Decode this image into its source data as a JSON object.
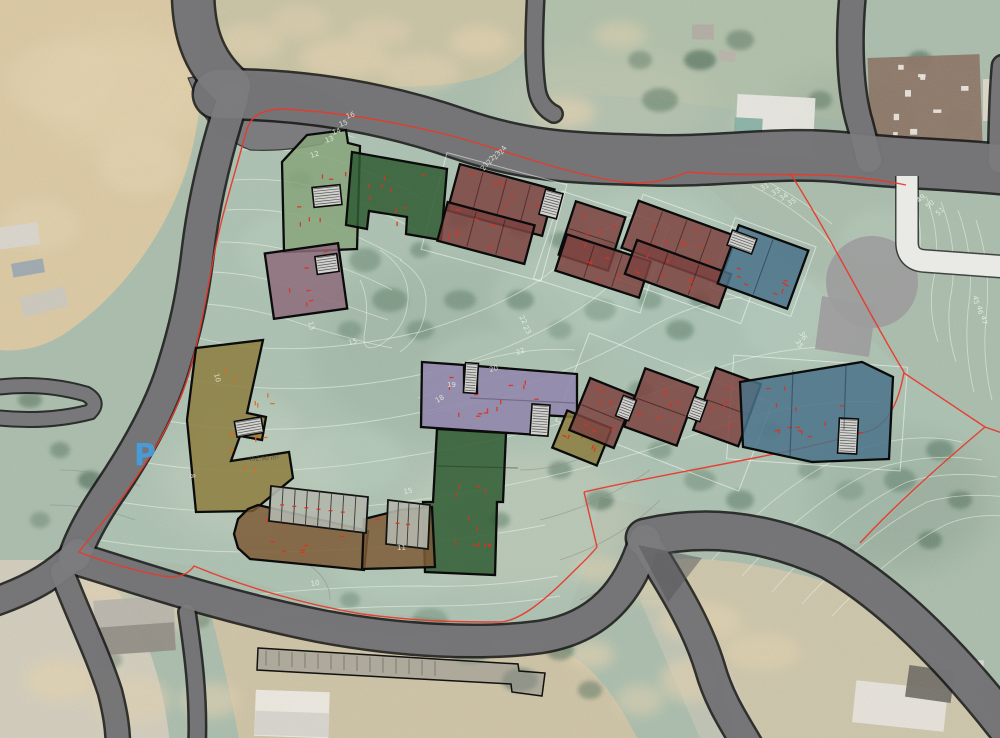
{
  "scene": {
    "description": "Architectural masterplan site plan overlaid on an aerial photograph with terraced housing blocks, contour lines and red plot boundary",
    "canvas_width": 1000,
    "canvas_height": 738
  },
  "palette": {
    "base_green": "#a9bcab",
    "road_fill": "#7c7c7e",
    "road_casing": "#151515",
    "white_path": "#e9e9e5",
    "plaza_gray": "#9d9d9d",
    "boundary_red": "#e8392b",
    "contour_light": "#edf4e4",
    "contour_gray": "#8f8c82",
    "stair_fill": "#d2d2cf",
    "tick_red": "#e0301e",
    "tick_orange": "#e8641c",
    "parking_blue": "#3fa2e8",
    "green_light": "#87a47b",
    "green_dark": "#2f5c33",
    "maroon": "#7c4341",
    "blue": "#4a7289",
    "purple": "#8f84ab",
    "mauve": "#8d6b7a",
    "olive": "#8c7d3e",
    "brown": "#7d5a36"
  },
  "labels": {
    "parking": {
      "text": "P",
      "color": "#3fa2e8"
    },
    "area_note": {
      "text": "452.90 m²",
      "x": 248,
      "y": 461,
      "r": -3
    },
    "contour_labels": [
      {
        "t": "16",
        "x": 347,
        "y": 119,
        "r": -20
      },
      {
        "t": "15",
        "x": 340,
        "y": 127,
        "r": -20
      },
      {
        "t": "14",
        "x": 333,
        "y": 135,
        "r": -20
      },
      {
        "t": "13",
        "x": 326,
        "y": 143,
        "r": -20
      },
      {
        "t": "12",
        "x": 311,
        "y": 158,
        "r": -18
      },
      {
        "t": "21",
        "x": 484,
        "y": 171,
        "r": -55
      },
      {
        "t": "22",
        "x": 490,
        "y": 165,
        "r": -55
      },
      {
        "t": "23",
        "x": 496,
        "y": 160,
        "r": -55
      },
      {
        "t": "24",
        "x": 502,
        "y": 155,
        "r": -55
      },
      {
        "t": "31",
        "x": 762,
        "y": 191,
        "r": -30
      },
      {
        "t": "33",
        "x": 773,
        "y": 196,
        "r": -30
      },
      {
        "t": "34",
        "x": 781,
        "y": 201,
        "r": -30
      },
      {
        "t": "35",
        "x": 789,
        "y": 206,
        "r": -30
      },
      {
        "t": "49",
        "x": 919,
        "y": 203,
        "r": -40
      },
      {
        "t": "50",
        "x": 928,
        "y": 209,
        "r": -40
      },
      {
        "t": "51",
        "x": 938,
        "y": 216,
        "r": -40
      },
      {
        "t": "45",
        "x": 973,
        "y": 296,
        "r": 80
      },
      {
        "t": "46",
        "x": 977,
        "y": 306,
        "r": 80
      },
      {
        "t": "47",
        "x": 981,
        "y": 316,
        "r": 80
      },
      {
        "t": "35",
        "x": 795,
        "y": 341,
        "r": 60
      },
      {
        "t": "36",
        "x": 799,
        "y": 333,
        "r": 60
      },
      {
        "t": "22",
        "x": 517,
        "y": 355,
        "r": -20
      },
      {
        "t": "20",
        "x": 490,
        "y": 372,
        "r": -15
      },
      {
        "t": "19",
        "x": 447,
        "y": 387,
        "r": 0
      },
      {
        "t": "18",
        "x": 437,
        "y": 403,
        "r": -30
      },
      {
        "t": "13",
        "x": 308,
        "y": 322,
        "r": 75
      },
      {
        "t": "15",
        "x": 349,
        "y": 345,
        "r": -15
      },
      {
        "t": "8",
        "x": 190,
        "y": 474,
        "r": 85
      },
      {
        "t": "10",
        "x": 214,
        "y": 374,
        "r": 75
      },
      {
        "t": "15",
        "x": 404,
        "y": 494,
        "r": -10
      },
      {
        "t": "10",
        "x": 311,
        "y": 586,
        "r": -8
      },
      {
        "t": "11",
        "x": 397,
        "y": 550,
        "r": 0
      },
      {
        "t": "22",
        "x": 519,
        "y": 317,
        "r": 60
      },
      {
        "t": "23",
        "x": 523,
        "y": 327,
        "r": 60
      }
    ]
  },
  "site": {
    "junction_pad": {
      "d": "M188,78 Q240,68 302,84 Q338,94 348,108 L322,144 Q282,152 250,150 Q216,136 202,112 Z"
    },
    "junction_wedge": {
      "d": "M638,545 L702,558 L668,602 Z"
    },
    "roads": [
      {
        "id": "road-north-approach",
        "d": "M193,-10 C193,28 201,60 230,86",
        "w": 40
      },
      {
        "id": "road-main-east",
        "d": "M218,94 C300,94 380,106 460,134 C530,158 580,158 645,160 C720,163 780,150 850,158 C905,164 955,164 1010,170",
        "w": 48
      },
      {
        "id": "road-west-diagonal",
        "d": "M233,98 C216,150 204,200 198,250 C192,300 185,330 173,368 C161,408 136,452 109,492 C92,517 81,538 75,556",
        "w": 30
      },
      {
        "id": "road-sw-exit",
        "d": "M78,552 C58,572 36,588 -12,604",
        "w": 26
      },
      {
        "id": "road-south",
        "d": "M74,558 C140,578 220,606 320,626 C400,641 480,645 540,637 C600,628 630,590 645,540",
        "w": 30
      },
      {
        "id": "road-se-sweep",
        "d": "M645,538 C700,525 760,528 830,560 C890,595 950,655 1005,725",
        "w": 36
      },
      {
        "id": "road-south-branch",
        "d": "M650,550 C675,590 698,628 710,668 C719,700 734,722 748,746",
        "w": 28
      },
      {
        "id": "road-ne-driveway",
        "d": "M853,-8 C848,40 850,92 860,124 C864,140 867,150 869,160",
        "w": 24
      },
      {
        "id": "road-north-stub",
        "d": "M536,-8 C534,30 533,62 537,90 C539,102 546,110 554,114",
        "w": 15
      },
      {
        "id": "road-east-stub",
        "d": "M1003,66 C1000,98 1000,128 999,162",
        "w": 20
      },
      {
        "id": "road-bottom-lane",
        "d": "M187,612 C193,652 199,696 197,746",
        "w": 15
      },
      {
        "id": "road-sw-down",
        "d": "M62,572 C77,612 97,652 110,692 C115,712 118,728 118,748",
        "w": 22
      }
    ],
    "road_loop": {
      "d": "M-28,392 Q30,378 86,394 Q100,402 90,412 Q36,426 -28,414 Z",
      "w": 13
    },
    "white_path": {
      "d": "M907,176 L907,242 Q907,260 925,261 L1008,267",
      "w": 21
    },
    "parking_strip": {
      "d": "M258,648 L518,664 L519,671 L545,673 L542,696 L512,692 L511,684 L257,670 Z"
    },
    "plaza": {
      "circle": [
        872,
        282,
        46
      ],
      "poly": [
        [
          822,
          296
        ],
        [
          876,
          306
        ],
        [
          869,
          357
        ],
        [
          815,
          349
        ]
      ]
    },
    "site_tint": [
      [
        252,
        110
      ],
      [
        450,
        138
      ],
      [
        620,
        182
      ],
      [
        690,
        170
      ],
      [
        905,
        372
      ],
      [
        983,
        428
      ],
      [
        858,
        545
      ],
      [
        600,
        497
      ],
      [
        588,
        560
      ],
      [
        560,
        632
      ],
      [
        500,
        624
      ],
      [
        350,
        610
      ],
      [
        196,
        566
      ],
      [
        80,
        552
      ],
      [
        128,
        488
      ],
      [
        190,
        366
      ],
      [
        214,
        250
      ],
      [
        240,
        130
      ]
    ],
    "boundary_red": [
      "M282,109 C340,112 392,121 452,136 C505,150 562,173 622,182 C648,185 668,180 688,172 C740,177 800,172 852,177 C872,179 892,182 906,185",
      "M282,109 C258,110 250,118 246,132 C236,170 223,210 215,250 C207,292 201,330 191,366 C181,406 157,448 129,488 C109,516 91,536 79,552",
      "M79,552 C98,560 132,570 162,576 C182,579 190,572 194,566 C242,586 302,604 362,614 C422,622 462,622 500,622 C520,621 545,600 570,575 C582,563 590,556 597,547",
      "M597,547 L584,492",
      "M584,492 C680,470 790,455 872,430 C892,420 900,395 904,372",
      "M904,373 L985,427 L1002,433",
      "M985,427 C940,465 895,505 860,543",
      "M790,173 C830,235 872,320 904,372"
    ],
    "guide_outlines": [
      [
        494,
        217,
        124,
        100,
        15
      ],
      [
        601,
        252,
        112,
        92,
        18
      ],
      [
        692,
        259,
        136,
        88,
        20
      ],
      [
        763,
        267,
        86,
        74,
        20
      ],
      [
        664,
        412,
        196,
        94,
        21
      ],
      [
        817,
        413,
        174,
        104,
        4
      ]
    ],
    "buildings": [
      {
        "id": "block-a1-light-green",
        "color": "green_light",
        "kind": "poly",
        "pts": [
          [
            307,
            135
          ],
          [
            346,
            130
          ],
          [
            348,
            143
          ],
          [
            360,
            146
          ],
          [
            357,
            249
          ],
          [
            284,
            252
          ],
          [
            282,
            162
          ]
        ],
        "ticks": 8
      },
      {
        "id": "block-a2-dark-green",
        "color": "green_dark",
        "kind": "poly",
        "pts": [
          [
            352,
            152
          ],
          [
            447,
            169
          ],
          [
            441,
            240
          ],
          [
            406,
            234
          ],
          [
            407,
            217
          ],
          [
            369,
            211
          ],
          [
            367,
            229
          ],
          [
            346,
            225
          ]
        ],
        "ticks": 9
      },
      {
        "id": "block-a4-mauve",
        "color": "mauve",
        "kind": "rect",
        "cx": 306,
        "cy": 281,
        "w": 74,
        "h": 66,
        "rot": -8,
        "units": 0,
        "ticks": 8
      },
      {
        "id": "block-b1-upper-maroon",
        "color": "maroon",
        "kind": "rect",
        "cx": 501,
        "cy": 200,
        "w": 98,
        "h": 48,
        "rot": 15,
        "units": 4,
        "ticks": 10
      },
      {
        "id": "block-b1-lower-maroon",
        "color": "maroon",
        "kind": "rect",
        "cx": 486,
        "cy": 233,
        "w": 90,
        "h": 40,
        "rot": 15,
        "units": 3,
        "ticks": 8
      },
      {
        "id": "block-b2-upper-maroon",
        "color": "maroon",
        "kind": "rect",
        "cx": 592,
        "cy": 236,
        "w": 52,
        "h": 56,
        "rot": 18,
        "units": 2,
        "ticks": 6
      },
      {
        "id": "block-b2-lower-maroon",
        "color": "maroon",
        "kind": "rect",
        "cx": 603,
        "cy": 266,
        "w": 88,
        "h": 38,
        "rot": 18,
        "units": 3,
        "ticks": 7
      },
      {
        "id": "block-b3-upper-maroon",
        "color": "maroon",
        "kind": "rect",
        "cx": 679,
        "cy": 242,
        "w": 104,
        "h": 50,
        "rot": 20,
        "units": 4,
        "ticks": 10
      },
      {
        "id": "block-b3-lower-maroon",
        "color": "maroon",
        "kind": "rect",
        "cx": 678,
        "cy": 274,
        "w": 100,
        "h": 36,
        "rot": 20,
        "units": 3,
        "ticks": 7
      },
      {
        "id": "block-b4-blue",
        "color": "blue",
        "kind": "rect",
        "cx": 763,
        "cy": 267,
        "w": 74,
        "h": 62,
        "rot": 20,
        "units": 2,
        "ticks": 8
      },
      {
        "id": "block-c1-purple",
        "color": "purple",
        "kind": "poly",
        "pts": [
          [
            422,
            362
          ],
          [
            464,
            365
          ],
          [
            464,
            392
          ],
          [
            477,
            393
          ],
          [
            477,
            366
          ],
          [
            577,
            374
          ],
          [
            577,
            417
          ],
          [
            539,
            415
          ],
          [
            539,
            435
          ],
          [
            421,
            427
          ]
        ],
        "ticks": 14
      },
      {
        "id": "block-c3-green",
        "color": "green_dark",
        "kind": "poly",
        "pts": [
          [
            437,
            429
          ],
          [
            506,
            433
          ],
          [
            503,
            502
          ],
          [
            497,
            502
          ],
          [
            495,
            575
          ],
          [
            425,
            572
          ],
          [
            423,
            502
          ],
          [
            433,
            502
          ]
        ],
        "ticks": 12
      },
      {
        "id": "block-c4-olive",
        "color": "olive",
        "kind": "rect",
        "cx": 582,
        "cy": 438,
        "w": 48,
        "h": 40,
        "rot": 22,
        "units": 0,
        "ticks": 5
      },
      {
        "id": "block-c5a-maroon",
        "color": "maroon",
        "kind": "rect",
        "cx": 602,
        "cy": 413,
        "w": 48,
        "h": 56,
        "rot": 22,
        "units": 2,
        "ticks": 7
      },
      {
        "id": "block-c5b-maroon",
        "color": "maroon",
        "kind": "rect",
        "cx": 661,
        "cy": 407,
        "w": 56,
        "h": 62,
        "rot": 20,
        "units": 2,
        "ticks": 7
      },
      {
        "id": "block-c5c-maroon",
        "color": "maroon",
        "kind": "rect",
        "cx": 727,
        "cy": 407,
        "w": 48,
        "h": 66,
        "rot": 20,
        "units": 2,
        "ticks": 7
      },
      {
        "id": "block-c6-blue",
        "color": "blue",
        "kind": "poly",
        "pts": [
          [
            740,
            382
          ],
          [
            862,
            362
          ],
          [
            893,
            377
          ],
          [
            889,
            459
          ],
          [
            812,
            462
          ],
          [
            743,
            447
          ]
        ],
        "ticks": 14
      },
      {
        "id": "block-d1-olive-hook",
        "color": "olive",
        "kind": "poly",
        "pts": [
          [
            196,
            348
          ],
          [
            263,
            340
          ],
          [
            247,
            413
          ],
          [
            266,
            417
          ],
          [
            262,
            440
          ],
          [
            240,
            436
          ],
          [
            231,
            461
          ],
          [
            289,
            452
          ],
          [
            293,
            478
          ],
          [
            253,
            511
          ],
          [
            196,
            512
          ],
          [
            187,
            420
          ]
        ],
        "ticks": 14,
        "tick_color": "orange"
      },
      {
        "id": "block-d3-brown-curve",
        "color": "brown",
        "kind": "poly",
        "pts": [
          [
            258,
            505
          ],
          [
            368,
            531
          ],
          [
            364,
            570
          ],
          [
            250,
            559
          ],
          [
            238,
            548
          ],
          [
            234,
            534
          ],
          [
            238,
            519
          ],
          [
            248,
            509
          ]
        ],
        "ticks": 8
      },
      {
        "id": "block-d4-brown",
        "color": "brown",
        "kind": "poly",
        "pts": [
          [
            364,
            519
          ],
          [
            400,
            510
          ],
          [
            432,
            507
          ],
          [
            435,
            567
          ],
          [
            362,
            569
          ]
        ],
        "ticks": 6
      }
    ],
    "stairwells": [
      [
        327,
        196,
        28,
        20,
        -6
      ],
      [
        551,
        204,
        18,
        26,
        15
      ],
      [
        742,
        242,
        26,
        16,
        20
      ],
      [
        471,
        378,
        13,
        30,
        4
      ],
      [
        540,
        420,
        18,
        31,
        4
      ],
      [
        626,
        408,
        14,
        22,
        21
      ],
      [
        697,
        409,
        14,
        22,
        20
      ],
      [
        848,
        436,
        19,
        35,
        3
      ],
      [
        249,
        427,
        27,
        16,
        -10
      ],
      [
        327,
        264,
        22,
        18,
        -8
      ]
    ],
    "unit_rows": [
      {
        "pts": [
          [
            271,
            486
          ],
          [
            368,
            497
          ],
          [
            366,
            533
          ],
          [
            269,
            521
          ]
        ],
        "n": 7
      },
      {
        "pts": [
          [
            388,
            500
          ],
          [
            430,
            505
          ],
          [
            428,
            549
          ],
          [
            386,
            544
          ]
        ],
        "n": 3
      }
    ],
    "detail_lines": [
      {
        "x1": 793,
        "y1": 370,
        "x2": 790,
        "y2": 456,
        "c": "rgba(15,35,55,0.4)"
      },
      {
        "x1": 846,
        "y1": 365,
        "x2": 844,
        "y2": 430,
        "c": "rgba(15,35,55,0.4)"
      },
      {
        "x1": 470,
        "y1": 398,
        "x2": 575,
        "y2": 403,
        "c": "rgba(40,30,60,0.3)"
      },
      {
        "x1": 437,
        "y1": 466,
        "x2": 518,
        "y2": 468,
        "c": "rgba(20,40,25,0.35)"
      }
    ]
  }
}
